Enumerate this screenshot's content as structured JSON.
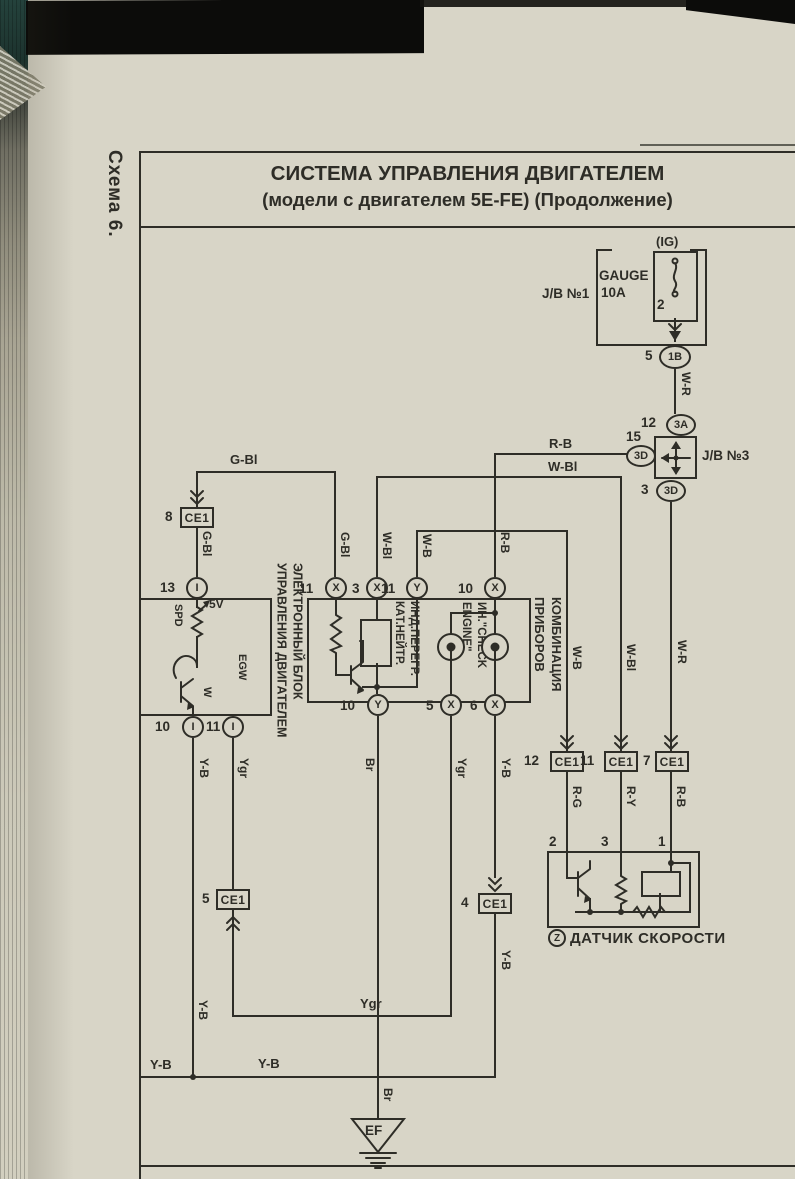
{
  "meta": {
    "schema_label": "Схема 6."
  },
  "title": {
    "line1": "СИСТЕМА УПРАВЛЕНИЯ ДВИГАТЕЛЕМ",
    "line2": "(модели с двигателем 5E-FE) (Продолжение)"
  },
  "jb1": {
    "name": "J/B №1",
    "ig": "(IG)",
    "fuse": "GAUGE",
    "rating": "10A",
    "pin": "2",
    "out_no": "5",
    "out_id": "1B"
  },
  "jb3": {
    "name": "J/B №3",
    "top_no": "12",
    "top_id": "3A",
    "left_no": "15",
    "left_id": "3D",
    "bot_no": "3",
    "bot_id": "3D"
  },
  "ecu": {
    "line1": "ЭЛЕКТРОННЫЙ БЛОК",
    "line2": "УПРАВЛЕНИЯ ДВИГАТЕЛЕМ",
    "spd": "SPD",
    "v5": "5V",
    "w": "W",
    "egw": "EGW",
    "top_no": "13",
    "top_id": "I",
    "b1_no": "10",
    "b1_id": "I",
    "b2_no": "11",
    "b2_id": "I"
  },
  "cluster": {
    "line1": "КОМБИНАЦИЯ",
    "line2": "ПРИБОРОВ",
    "ind1_l1": "ИНД.ПЕРЕГР.",
    "ind1_l2": "КАТ.НЕЙТР.",
    "ind2_l1": "ИН.\"CHECK",
    "ind2_l2": "ENGINE\"",
    "t1_no": "11",
    "t1_id": "X",
    "t2_no": "3",
    "t2_id": "X",
    "t3_no": "11",
    "t3_id": "Y",
    "t4_no": "10",
    "t4_id": "X",
    "b1_no": "10",
    "b1_id": "Y",
    "b2_no": "5",
    "b2_id": "X",
    "b3_no": "6",
    "b3_id": "X"
  },
  "sensor": {
    "z": "Z",
    "name": "ДАТЧИК СКОРОСТИ",
    "p1": "2",
    "p2": "3",
    "p3": "1"
  },
  "ce1": {
    "name": "CE1",
    "n8": "8",
    "n5": "5",
    "n4": "4",
    "n12": "12",
    "n11": "11",
    "n7": "7"
  },
  "wires": {
    "g_bl": "G-Bl",
    "w_bl": "W-Bl",
    "w_b": "W-B",
    "w_r": "W-R",
    "r_b": "R-B",
    "r_g": "R-G",
    "r_y": "R-Y",
    "y_b": "Y-B",
    "ygr": "Ygr",
    "br": "Br"
  },
  "ground": {
    "label": "EF"
  },
  "colors": {
    "ink": "#2e2d27",
    "paper": "#d8d5c7"
  }
}
